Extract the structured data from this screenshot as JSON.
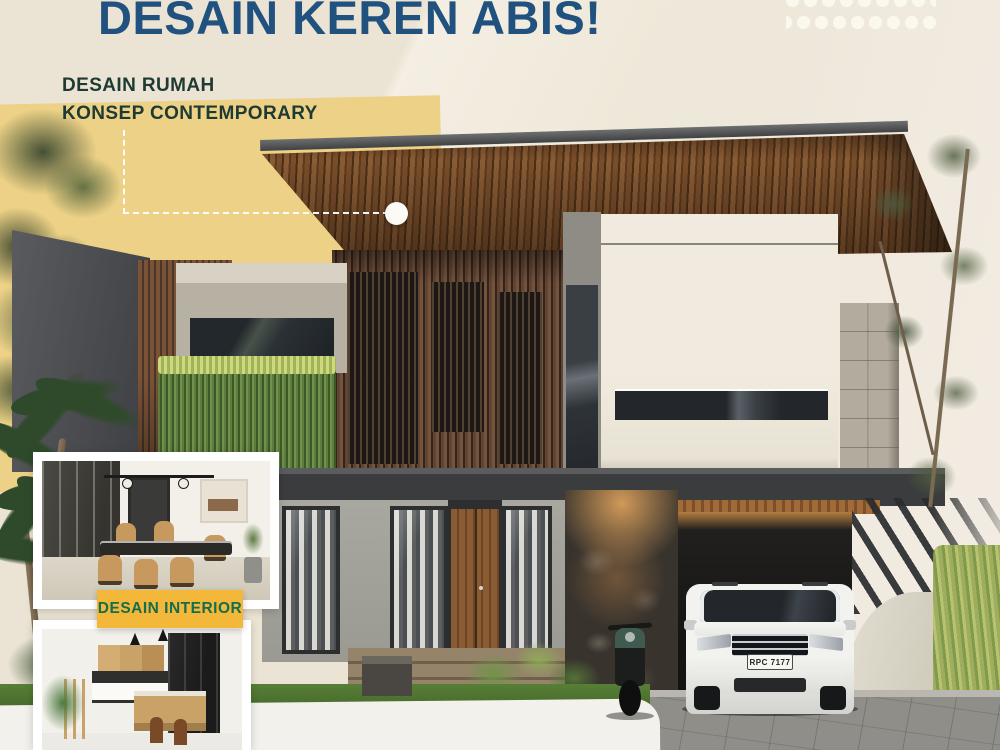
{
  "header": {
    "headline": "DESAIN KEREN ABIS!",
    "subtitle_line1": "DESAIN RUMAH",
    "subtitle_line2": "KONSEP CONTEMPORARY"
  },
  "interior_section": {
    "badge_label": "DESAIN INTERIOR"
  },
  "vehicle": {
    "license_plate": "RPC 7177"
  },
  "brand": {
    "logo_icon": "dots-grid-logo"
  },
  "colors": {
    "headline_blue": "#20517f",
    "subtitle_dark_green": "#1e3a32",
    "badge_yellow": "#f3b73a",
    "badge_text_green": "#156d4d",
    "yellow_accent_block": "#ecd186",
    "cream_background": "#ebe4d4",
    "roof_wood_brown": "#7a4e2a",
    "callout_white": "#ffffff"
  }
}
